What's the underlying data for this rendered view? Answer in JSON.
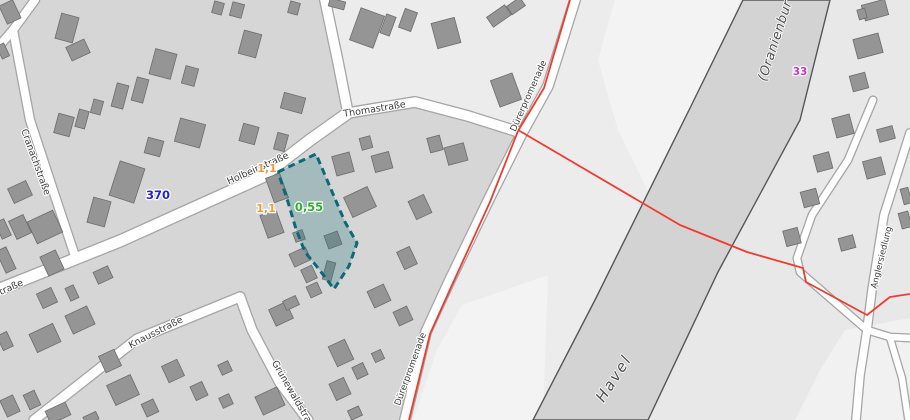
{
  "map": {
    "colors": {
      "base": "#d6d6d6",
      "block_light": "#ececec",
      "east_bank": "#e8e8e8",
      "meadow": "#f3f3f3",
      "river_fill": "#d3d3d3",
      "river_stroke": "#565656",
      "road_fill": "#ffffff",
      "road_casing": "#a6a6a6",
      "building_fill": "#959595",
      "building_stroke": "#6d6d6d",
      "boundary_red": "#f23b2f",
      "parcel_fill": "rgba(30,115,125,0.27)",
      "parcel_stroke": "#0b6a78",
      "value_blue": "#2222e0",
      "value_orange": "#ee9b3f",
      "value_green": "#2bb32b",
      "value_magenta": "#cb30cb"
    },
    "areas": [
      {
        "id": "ne-block",
        "fill": "#ececec",
        "pts": [
          [
            325,
            0
          ],
          [
            342,
            105
          ],
          [
            348,
            113
          ],
          [
            415,
            101
          ],
          [
            522,
            133
          ],
          [
            575,
            0
          ]
        ]
      },
      {
        "id": "riverside-strip",
        "fill": "#ececec",
        "pts": [
          [
            575,
            0
          ],
          [
            522,
            133
          ],
          [
            490,
            197
          ],
          [
            449,
            282
          ],
          [
            426,
            332
          ],
          [
            405,
            420
          ],
          [
            545,
            420
          ],
          [
            598,
            295
          ],
          [
            693,
            105
          ],
          [
            743,
            0
          ]
        ]
      },
      {
        "id": "east-bank",
        "fill": "#e8e8e8",
        "pts": [
          [
            826,
            0
          ],
          [
            910,
            0
          ],
          [
            910,
            420
          ],
          [
            646,
            420
          ],
          [
            716,
            272
          ],
          [
            797,
            118
          ]
        ]
      },
      {
        "id": "meadow-north",
        "fill": "#f3f3f3",
        "pts": [
          [
            615,
            0
          ],
          [
            740,
            0
          ],
          [
            693,
            130
          ],
          [
            652,
            200
          ],
          [
            618,
            130
          ],
          [
            598,
            60
          ]
        ]
      },
      {
        "id": "meadow-south",
        "fill": "#f3f3f3",
        "pts": [
          [
            462,
            305
          ],
          [
            548,
            275
          ],
          [
            543,
            420
          ],
          [
            413,
            420
          ],
          [
            437,
            350
          ]
        ]
      },
      {
        "id": "meadow-southeast",
        "fill": "#f1f1f1",
        "pts": [
          [
            845,
            330
          ],
          [
            910,
            318
          ],
          [
            910,
            420
          ],
          [
            795,
            420
          ],
          [
            820,
            370
          ]
        ]
      }
    ],
    "river": {
      "name_labels": [
        "Havel",
        "(Oranienbur"
      ],
      "pts": [
        [
          743,
          0
        ],
        [
          830,
          0
        ],
        [
          800,
          120
        ],
        [
          718,
          272
        ],
        [
          648,
          420
        ],
        [
          533,
          420
        ],
        [
          596,
          298
        ],
        [
          692,
          104
        ]
      ]
    },
    "streets": [
      {
        "id": "holbeinstrasse",
        "width": 11,
        "pts": [
          [
            0,
            289
          ],
          [
            120,
            241
          ],
          [
            220,
            196
          ],
          [
            262,
            177
          ],
          [
            310,
            140
          ],
          [
            348,
            113
          ]
        ]
      },
      {
        "id": "thomastrasse",
        "width": 9.5,
        "pts": [
          [
            325,
            0
          ],
          [
            338,
            62
          ],
          [
            348,
            113
          ],
          [
            415,
            102
          ],
          [
            468,
            116
          ],
          [
            522,
            133
          ]
        ]
      },
      {
        "id": "duererpromenade",
        "width": 9.5,
        "pts": [
          [
            575,
            0
          ],
          [
            548,
            86
          ],
          [
            522,
            133
          ],
          [
            490,
            197
          ],
          [
            449,
            282
          ],
          [
            426,
            332
          ],
          [
            405,
            420
          ]
        ]
      },
      {
        "id": "cranachstrasse",
        "width": 8,
        "pts": [
          [
            13,
            30
          ],
          [
            30,
            120
          ],
          [
            55,
            196
          ],
          [
            75,
            256
          ]
        ]
      },
      {
        "id": "corner-lane",
        "width": 8,
        "pts": [
          [
            35,
            0
          ],
          [
            13,
            30
          ],
          [
            0,
            45
          ]
        ]
      },
      {
        "id": "knausstrasse",
        "width": 9,
        "pts": [
          [
            34,
            420
          ],
          [
            137,
            339
          ],
          [
            240,
            297
          ]
        ]
      },
      {
        "id": "gruenewaldstrasse",
        "width": 9,
        "pts": [
          [
            240,
            297
          ],
          [
            252,
            330
          ],
          [
            280,
            383
          ],
          [
            308,
            420
          ]
        ]
      },
      {
        "id": "siedlung-lane-west",
        "width": 6.5,
        "pts": [
          [
            873,
            100
          ],
          [
            848,
            160
          ],
          [
            812,
            215
          ],
          [
            797,
            258
          ],
          [
            800,
            272
          ],
          [
            867,
            330
          ]
        ]
      },
      {
        "id": "anglersiedlung",
        "width": 7.5,
        "pts": [
          [
            910,
            133
          ],
          [
            884,
            215
          ],
          [
            872,
            290
          ],
          [
            867,
            330
          ],
          [
            860,
            375
          ],
          [
            856,
            420
          ]
        ]
      },
      {
        "id": "siedlung-branch-east",
        "width": 6.5,
        "pts": [
          [
            867,
            330
          ],
          [
            890,
            337
          ],
          [
            910,
            338
          ]
        ]
      },
      {
        "id": "siedlung-branch-corner",
        "width": 6,
        "pts": [
          [
            890,
            338
          ],
          [
            902,
            378
          ],
          [
            908,
            418
          ]
        ]
      }
    ],
    "street_labels": [
      {
        "id": "cranachstrasse",
        "text": "Cranachstraße",
        "x": 33,
        "y": 163,
        "rot": 70,
        "size": 9.5
      },
      {
        "id": "holbeinstrasse",
        "text": "Holbeinstraße",
        "x": 259,
        "y": 171,
        "rot": -24,
        "size": 9.5
      },
      {
        "id": "holbeinstrasse-partial",
        "text": "straße",
        "x": 10,
        "y": 291,
        "rot": -24,
        "size": 9.5
      },
      {
        "id": "knausstrasse",
        "text": "Knausstraße",
        "x": 157,
        "y": 335,
        "rot": -27,
        "size": 9.5
      },
      {
        "id": "thomastrasse",
        "text": "Thomastraße",
        "x": 375,
        "y": 112,
        "rot": -9,
        "size": 9.5
      },
      {
        "id": "duererpromenade-north",
        "text": "Dürerpromenade",
        "x": 531,
        "y": 97,
        "rot": -66,
        "size": 9
      },
      {
        "id": "duererpromenade-south",
        "text": "Dürerpromenade",
        "x": 413,
        "y": 370,
        "rot": -70,
        "size": 9
      },
      {
        "id": "gruenewaldstrasse",
        "text": "Grünewaldstraße",
        "x": 292,
        "y": 398,
        "rot": 60,
        "size": 9.5
      },
      {
        "id": "anglersiedlung",
        "text": "Anglersiedlung",
        "x": 884,
        "y": 258,
        "rot": -76,
        "size": 8.5
      }
    ],
    "water_labels": [
      {
        "id": "havel",
        "text": "Havel",
        "x": 618,
        "y": 381,
        "rot": -57,
        "size": 15,
        "spacing": 2
      },
      {
        "id": "oranienburger-havel",
        "text": "(Oranienbur",
        "x": 779,
        "y": 42,
        "rot": -72,
        "size": 13,
        "spacing": 0.5
      }
    ],
    "value_labels": [
      {
        "id": "brw-370",
        "text": "370",
        "x": 158,
        "y": 199,
        "color": "#2222e0",
        "size": 11.5
      },
      {
        "id": "brw-1-1-a",
        "text": "1,1",
        "x": 267,
        "y": 172,
        "color": "#ee9b3f",
        "size": 11
      },
      {
        "id": "brw-1-1-b",
        "text": "1,1",
        "x": 266,
        "y": 212,
        "color": "#ee9b3f",
        "size": 11
      },
      {
        "id": "brw-0-55",
        "text": "0,55",
        "x": 309,
        "y": 211,
        "color": "#2bb32b",
        "size": 11.5
      },
      {
        "id": "brw-33",
        "text": "33",
        "x": 800,
        "y": 75,
        "color": "#cb30cb",
        "size": 10.5
      }
    ],
    "parcel": {
      "value": "0,55",
      "pts": [
        [
          278,
          172
        ],
        [
          316,
          154
        ],
        [
          333,
          194
        ],
        [
          345,
          222
        ],
        [
          357,
          243
        ],
        [
          349,
          266
        ],
        [
          334,
          289
        ],
        [
          318,
          268
        ],
        [
          305,
          252
        ],
        [
          296,
          229
        ],
        [
          288,
          202
        ]
      ]
    },
    "red_boundary": [
      {
        "id": "boundary-along-promenade",
        "pts": [
          [
            570,
            0
          ],
          [
            544,
            88
          ],
          [
            518,
            131
          ],
          [
            490,
            202
          ],
          [
            452,
            285
          ],
          [
            430,
            334
          ],
          [
            409,
            420
          ]
        ]
      },
      {
        "id": "boundary-crossing-havel",
        "pts": [
          [
            518,
            130
          ],
          [
            680,
            225
          ],
          [
            747,
            252
          ],
          [
            803,
            268
          ],
          [
            806,
            282
          ],
          [
            867,
            315
          ],
          [
            890,
            297
          ],
          [
            910,
            294
          ]
        ]
      }
    ],
    "buildings": [
      [
        10,
        12,
        15,
        20,
        -25
      ],
      [
        3,
        51,
        8,
        14,
        -25
      ],
      [
        67,
        28,
        18,
        26,
        15
      ],
      [
        78,
        50,
        20,
        15,
        -25
      ],
      [
        120,
        96,
        12,
        24,
        15
      ],
      [
        140,
        90,
        12,
        24,
        15
      ],
      [
        163,
        64,
        22,
        26,
        15
      ],
      [
        190,
        76,
        13,
        18,
        15
      ],
      [
        218,
        8,
        10,
        12,
        15
      ],
      [
        237,
        10,
        12,
        14,
        15
      ],
      [
        250,
        44,
        18,
        24,
        15
      ],
      [
        294,
        8,
        10,
        12,
        15
      ],
      [
        293,
        103,
        22,
        16,
        15
      ],
      [
        64,
        125,
        16,
        20,
        15
      ],
      [
        82,
        119,
        10,
        18,
        15
      ],
      [
        97,
        107,
        10,
        14,
        15
      ],
      [
        154,
        147,
        16,
        16,
        15
      ],
      [
        190,
        133,
        26,
        24,
        15
      ],
      [
        249,
        134,
        16,
        18,
        15
      ],
      [
        281,
        142,
        11,
        17,
        15
      ],
      [
        127,
        182,
        26,
        36,
        18
      ],
      [
        99,
        212,
        18,
        26,
        15
      ],
      [
        20,
        192,
        20,
        16,
        -25
      ],
      [
        20,
        227,
        16,
        20,
        -25
      ],
      [
        3,
        229,
        10,
        18,
        -25
      ],
      [
        45,
        227,
        28,
        24,
        -25
      ],
      [
        52,
        263,
        17,
        21,
        -25
      ],
      [
        6,
        260,
        11,
        24,
        -25
      ],
      [
        47,
        298,
        16,
        16,
        -25
      ],
      [
        72,
        293,
        9,
        14,
        -25
      ],
      [
        103,
        275,
        16,
        13,
        -25
      ],
      [
        80,
        320,
        24,
        20,
        -25
      ],
      [
        45,
        338,
        26,
        20,
        -25
      ],
      [
        5,
        341,
        11,
        16,
        -25
      ],
      [
        110,
        361,
        17,
        18,
        -25
      ],
      [
        173,
        371,
        17,
        18,
        -25
      ],
      [
        225,
        368,
        11,
        11,
        -25
      ],
      [
        199,
        391,
        13,
        15,
        -25
      ],
      [
        226,
        401,
        11,
        11,
        -25
      ],
      [
        123,
        390,
        26,
        22,
        -25
      ],
      [
        150,
        408,
        13,
        14,
        -25
      ],
      [
        10,
        406,
        14,
        18,
        -25
      ],
      [
        32,
        400,
        12,
        16,
        -25
      ],
      [
        58,
        413,
        22,
        14,
        -25
      ],
      [
        91,
        418,
        14,
        8,
        -25
      ],
      [
        281,
        314,
        19,
        18,
        -25
      ],
      [
        270,
        401,
        24,
        20,
        -25
      ],
      [
        277,
        188,
        15,
        26,
        -20
      ],
      [
        272,
        224,
        17,
        24,
        -20
      ],
      [
        299,
        236,
        10,
        10,
        -20
      ],
      [
        333,
        240,
        14,
        14,
        -20
      ],
      [
        329,
        271,
        9,
        19,
        15
      ],
      [
        300,
        257,
        18,
        14,
        -25
      ],
      [
        309,
        274,
        12,
        14,
        -25
      ],
      [
        314,
        290,
        12,
        12,
        -25
      ],
      [
        291,
        303,
        14,
        10,
        -25
      ],
      [
        343,
        164,
        18,
        20,
        -15
      ],
      [
        366,
        143,
        11,
        12,
        -15
      ],
      [
        382,
        162,
        18,
        17,
        -15
      ],
      [
        360,
        202,
        26,
        22,
        -25
      ],
      [
        420,
        207,
        17,
        20,
        -25
      ],
      [
        407,
        258,
        14,
        19,
        -25
      ],
      [
        435,
        144,
        13,
        15,
        -15
      ],
      [
        456,
        154,
        20,
        18,
        -15
      ],
      [
        379,
        296,
        18,
        18,
        -25
      ],
      [
        403,
        316,
        15,
        15,
        -25
      ],
      [
        341,
        353,
        18,
        22,
        -25
      ],
      [
        360,
        371,
        12,
        13,
        -25
      ],
      [
        378,
        356,
        10,
        10,
        -25
      ],
      [
        340,
        389,
        16,
        18,
        -25
      ],
      [
        355,
        413,
        12,
        10,
        -25
      ],
      [
        337,
        4,
        16,
        8,
        15
      ],
      [
        367,
        28,
        25,
        34,
        20
      ],
      [
        388,
        25,
        10,
        20,
        20
      ],
      [
        408,
        20,
        13,
        20,
        20
      ],
      [
        446,
        33,
        24,
        26,
        -15
      ],
      [
        499,
        16,
        22,
        12,
        -35
      ],
      [
        516,
        6,
        16,
        10,
        -35
      ],
      [
        506,
        90,
        23,
        28,
        -20
      ],
      [
        875,
        10,
        24,
        16,
        -15
      ],
      [
        862,
        14,
        8,
        10,
        -15
      ],
      [
        868,
        46,
        26,
        20,
        -15
      ],
      [
        859,
        82,
        16,
        16,
        -15
      ],
      [
        843,
        126,
        18,
        20,
        -15
      ],
      [
        886,
        134,
        16,
        13,
        -15
      ],
      [
        823,
        162,
        16,
        17,
        -15
      ],
      [
        874,
        168,
        19,
        18,
        -15
      ],
      [
        810,
        198,
        16,
        16,
        -15
      ],
      [
        792,
        237,
        15,
        16,
        -15
      ],
      [
        847,
        243,
        15,
        13,
        -15
      ],
      [
        905,
        220,
        10,
        16,
        -15
      ],
      [
        906,
        196,
        8,
        16,
        -15
      ]
    ]
  }
}
